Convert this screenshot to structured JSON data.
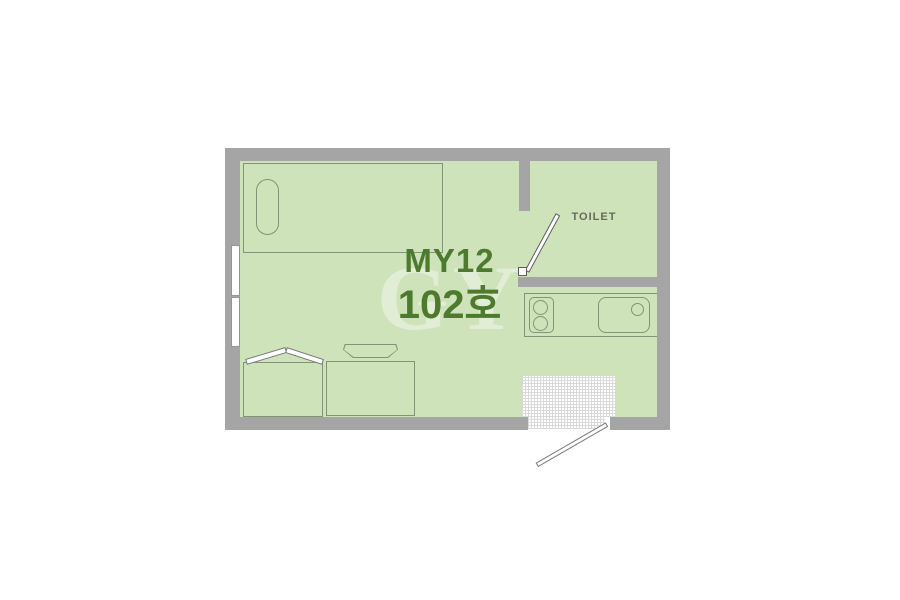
{
  "floorplan": {
    "title": {
      "line1": "MY12",
      "line2": "102호"
    },
    "toilet": {
      "label": "TOILET"
    },
    "watermark": "GY",
    "colors": {
      "floor": "#cfe3ba",
      "wall": "#a5a5a5",
      "outline": "#839377",
      "title-text": "#4d7a2e",
      "toilet-text": "#666b5e",
      "mat-grid": "#d9d9d9"
    }
  }
}
